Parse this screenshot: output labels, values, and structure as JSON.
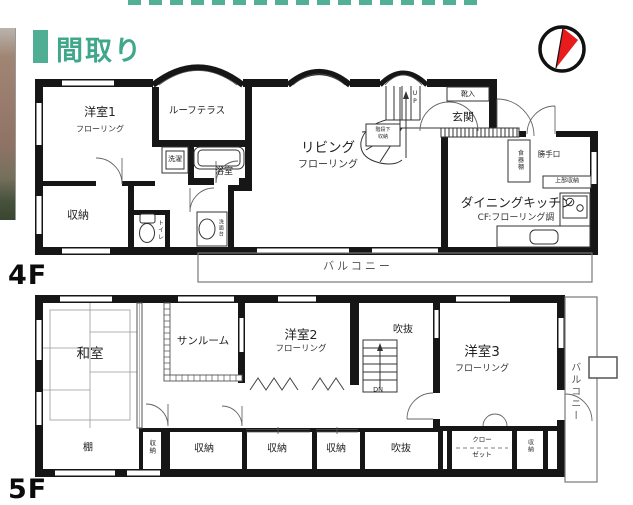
{
  "header": {
    "title": "間取り"
  },
  "floor4": {
    "label": "4F",
    "rooms": {
      "western_room1": "洋室1",
      "western_room1_floor": "フローリング",
      "roof_terrace": "ルーフテラス",
      "living": "リビング",
      "living_floor": "フローリング",
      "entrance": "玄関",
      "shoe_cabinet": "靴入",
      "dining_kitchen": "ダイニングキッチン",
      "dining_kitchen_floor": "CF:フローリング調",
      "storage": "収納",
      "laundry": "洗濯",
      "bath": "浴室",
      "toilet": "トイレ",
      "washstand": "洗面台",
      "under_stairs_storage_1": "階段下",
      "under_stairs_storage_2": "収納",
      "stairs_up": "UP",
      "cupboard": "食器棚",
      "back_door": "勝手口",
      "upper_storage": "上部収納",
      "balcony": "バルコニー"
    }
  },
  "floor5": {
    "label": "5F",
    "rooms": {
      "japanese_room": "和室",
      "sunroom": "サンルーム",
      "western_room2": "洋室2",
      "western_room2_floor": "フローリング",
      "void_upper": "吹抜",
      "stairs_down": "DN",
      "western_room3": "洋室3",
      "western_room3_floor": "フローリング",
      "shelf": "棚",
      "storage_a": "収納",
      "storage_b": "収納",
      "storage_c": "収納",
      "storage_d": "収納",
      "void_lower": "吹抜",
      "closet_1": "クロー",
      "closet_2": "ゼット",
      "storage_e": "収納",
      "balcony": "バルコニー"
    }
  },
  "colors": {
    "accent": "#45a78c",
    "wall": "#161616",
    "compass_needle": "#e81c1c"
  }
}
